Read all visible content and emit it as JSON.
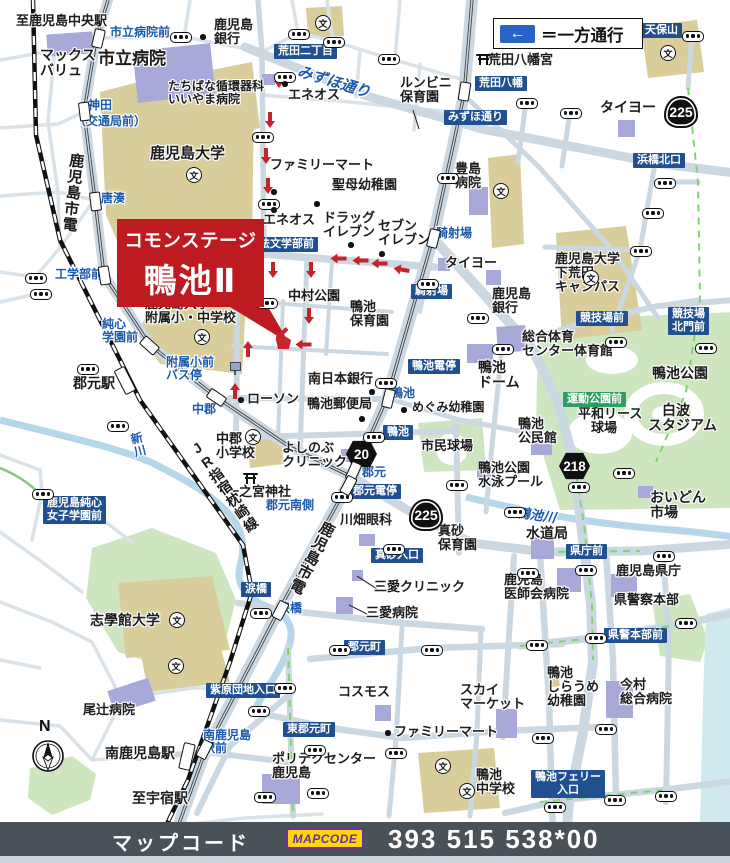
{
  "legend": {
    "arrow": "←",
    "text": "＝一方通行"
  },
  "banner": {
    "line1": "コモンステージ",
    "line2": "鴨池Ⅱ"
  },
  "footer": {
    "label": "マップコード",
    "logo": "MAPCODE",
    "code": "393 515 538*00"
  },
  "compass": {
    "label": "N"
  },
  "colors": {
    "banner_red": "#bd1a21",
    "sign_navy": "#20508f",
    "sign_green": "#2f9e63",
    "blue_text": "#1b59ab",
    "road": "#cbd8e2",
    "campus_tan": "#d8cd9b",
    "park_green": "#cde6c0",
    "building_purple": "#a9a9d9",
    "water": "#b5d7ea",
    "oneway_red": "#c4232a",
    "bar_gray": "#495159",
    "mapcode_yellow": "#ffd60a",
    "mapcode_purple": "#6b2fa0"
  },
  "labels": [
    {
      "t": "至鹿児島中央駅",
      "x": 16,
      "y": 14,
      "n": "dest-kagoshima-chuo-sta"
    },
    {
      "t": "マックス\nバリュ",
      "x": 40,
      "y": 48,
      "s": 14,
      "n": "poi-max-valu"
    },
    {
      "t": "市立病院",
      "x": 98,
      "y": 50,
      "s": 17,
      "n": "poi-city-hospital"
    },
    {
      "t": "鹿児島\n銀行",
      "x": 214,
      "y": 18,
      "n": "poi-kagoshima-bank-1"
    },
    {
      "t": "たちばな循環器科\nいいやま病院",
      "x": 168,
      "y": 80,
      "s": 12,
      "n": "poi-tachibana-iiyama-hospital"
    },
    {
      "t": "エネオス",
      "x": 288,
      "y": 88,
      "n": "poi-eneos-1"
    },
    {
      "t": "ルンビニ\n保育園",
      "x": 400,
      "y": 76,
      "n": "poi-lumbini-nursery"
    },
    {
      "t": "荒田八幡宮",
      "x": 488,
      "y": 53,
      "n": "poi-arata-hachimangu"
    },
    {
      "t": "タイヨー",
      "x": 600,
      "y": 100,
      "s": 14,
      "n": "poi-taiyo-1"
    },
    {
      "t": "鹿児島大学",
      "x": 150,
      "y": 146,
      "s": 15,
      "n": "poi-kagoshima-univ"
    },
    {
      "t": "ファミリーマート",
      "x": 270,
      "y": 158,
      "n": "poi-familymart-1"
    },
    {
      "t": "聖母幼稚園",
      "x": 332,
      "y": 178,
      "n": "poi-seibo-kindergarten"
    },
    {
      "t": "エネオス",
      "x": 263,
      "y": 213,
      "n": "poi-eneos-2"
    },
    {
      "t": "ドラッグ\nイレブン",
      "x": 323,
      "y": 211,
      "n": "poi-drug-eleven"
    },
    {
      "t": "セブン\nイレブン",
      "x": 378,
      "y": 219,
      "n": "poi-seven-eleven"
    },
    {
      "t": "豊島\n病院",
      "x": 455,
      "y": 162,
      "n": "poi-toyoshima-hospital"
    },
    {
      "t": "タイヨー",
      "x": 445,
      "y": 256,
      "n": "poi-taiyo-2"
    },
    {
      "t": "鹿児島\n銀行",
      "x": 492,
      "y": 287,
      "n": "poi-kagoshima-bank-2"
    },
    {
      "t": "鹿児島大学\n下荒田\nキャンパス",
      "x": 555,
      "y": 252,
      "n": "poi-shimoarata-campus"
    },
    {
      "t": "中村公園",
      "x": 288,
      "y": 289,
      "n": "poi-nakamura-park"
    },
    {
      "t": "鴨池\n保育園",
      "x": 350,
      "y": 300,
      "n": "poi-kamoike-nursery"
    },
    {
      "t": "南日本銀行",
      "x": 308,
      "y": 372,
      "n": "poi-minami-nippon-bank"
    },
    {
      "t": "鴨池郵便局",
      "x": 307,
      "y": 397,
      "n": "poi-kamoike-post-office"
    },
    {
      "t": "めぐみ幼稚園",
      "x": 412,
      "y": 401,
      "s": 12,
      "n": "poi-megumi-kindergarten"
    },
    {
      "t": "ローソン",
      "x": 247,
      "y": 392,
      "n": "poi-lawson"
    },
    {
      "t": "市民球場",
      "x": 421,
      "y": 439,
      "n": "poi-shimin-stadium"
    },
    {
      "t": "中郡\n小学校",
      "x": 216,
      "y": 432,
      "n": "poi-nakagori-elementary"
    },
    {
      "t": "よしのぶ\nクリニック",
      "x": 282,
      "y": 441,
      "n": "poi-yoshinobu-clinic"
    },
    {
      "t": "一之宮神社",
      "x": 226,
      "y": 485,
      "n": "poi-ichinomiya-shrine"
    },
    {
      "t": "川畑眼科",
      "x": 340,
      "y": 513,
      "n": "poi-kawabata-eye-clinic"
    },
    {
      "t": "真砂\n保育園",
      "x": 438,
      "y": 524,
      "n": "poi-masago-nursery"
    },
    {
      "t": "三愛クリニック",
      "x": 374,
      "y": 580,
      "n": "poi-sanai-clinic"
    },
    {
      "t": "三愛病院",
      "x": 366,
      "y": 606,
      "n": "poi-sanai-hospital"
    },
    {
      "t": "コスモス",
      "x": 338,
      "y": 685,
      "n": "poi-cosmos"
    },
    {
      "t": "スカイ\nマーケット",
      "x": 460,
      "y": 683,
      "n": "poi-sky-market"
    },
    {
      "t": "ファミリーマート",
      "x": 394,
      "y": 725,
      "n": "poi-familymart-2"
    },
    {
      "t": "ポリテクセンター\n鹿児島",
      "x": 272,
      "y": 752,
      "n": "poi-polytech-center"
    },
    {
      "t": "鴨池\n中学校",
      "x": 476,
      "y": 768,
      "n": "poi-kamoike-junior-high"
    },
    {
      "t": "鴨池\nしらうめ\n幼稚園",
      "x": 547,
      "y": 666,
      "n": "poi-shiraume-kindergarten"
    },
    {
      "t": "今村\n総合病院",
      "x": 620,
      "y": 678,
      "n": "poi-imamura-hospital"
    },
    {
      "t": "鹿児島\n医師会病院",
      "x": 504,
      "y": 573,
      "n": "poi-ishikai-hospital"
    },
    {
      "t": "鹿児島県庁",
      "x": 616,
      "y": 564,
      "n": "poi-pref-office"
    },
    {
      "t": "県警察本部",
      "x": 614,
      "y": 593,
      "n": "poi-pref-police-hq"
    },
    {
      "t": "水道局",
      "x": 526,
      "y": 526,
      "s": 14,
      "n": "poi-waterworks"
    },
    {
      "t": "おいどん\n市場",
      "x": 650,
      "y": 490,
      "s": 14,
      "n": "poi-oidon-market"
    },
    {
      "t": "総合体育\nセンター体育館",
      "x": 522,
      "y": 330,
      "n": "poi-sogo-gym"
    },
    {
      "t": "鴨池\nドーム",
      "x": 478,
      "y": 360,
      "s": 14,
      "n": "poi-kamoike-dome"
    },
    {
      "t": "鴨池公園",
      "x": 652,
      "y": 366,
      "s": 14,
      "n": "poi-kamoike-park"
    },
    {
      "t": "　白波\nスタジアム",
      "x": 648,
      "y": 403,
      "s": 14,
      "n": "poi-shiranami-stadium"
    },
    {
      "t": "平和リース\n　球場",
      "x": 578,
      "y": 407,
      "n": "poi-heiwa-lease-stadium"
    },
    {
      "t": "鴨池\n公民館",
      "x": 518,
      "y": 417,
      "n": "poi-kamoike-kominkan"
    },
    {
      "t": "鴨池公園\n水泳プール",
      "x": 478,
      "y": 461,
      "n": "poi-kamoike-pool"
    },
    {
      "t": "志學館大学",
      "x": 90,
      "y": 613,
      "s": 14,
      "n": "poi-shigakukan-univ"
    },
    {
      "t": "尾辻病院",
      "x": 83,
      "y": 703,
      "n": "poi-otsuji-hospital"
    },
    {
      "t": "南鹿児島駅",
      "x": 105,
      "y": 746,
      "s": 14,
      "n": "poi-minami-kagoshima-sta"
    },
    {
      "t": "至宇宿駅",
      "x": 132,
      "y": 791,
      "s": 14,
      "n": "dest-usuki-sta"
    },
    {
      "t": "郡元駅",
      "x": 73,
      "y": 376,
      "s": 14,
      "n": "poi-korimoto-sta"
    },
    {
      "t": "鹿児島大学\n附属小・中学校",
      "x": 145,
      "y": 297,
      "n": "poi-fuzoku-school"
    },
    {
      "t": "鹿児島市電",
      "x": 68,
      "y": 152,
      "s": 15,
      "c": "v",
      "r": 6,
      "n": "line-shiden-upper"
    },
    {
      "t": "鹿児島市電",
      "x": 322,
      "y": 518,
      "s": 15,
      "c": "v",
      "r": 27,
      "n": "line-shiden-lower"
    },
    {
      "t": "JR指宿枕崎線",
      "x": 186,
      "y": 446,
      "s": 14,
      "c": "v",
      "r": -35,
      "n": "line-jr-ibusuki-makurazaki"
    },
    {
      "t": "市立病院前",
      "x": 110,
      "y": 26,
      "s": 12,
      "c": "b",
      "n": "stop-shiritsu-byoin-mae"
    },
    {
      "t": "神田",
      "x": 88,
      "y": 99,
      "s": 12,
      "c": "b",
      "n": "stop-kanda"
    },
    {
      "t": "（交通局前）",
      "x": 74,
      "y": 115,
      "s": 12,
      "c": "b",
      "n": "stop-kotsukyoku-mae"
    },
    {
      "t": "唐湊",
      "x": 101,
      "y": 192,
      "s": 12,
      "c": "b",
      "n": "stop-toso"
    },
    {
      "t": "工学部前",
      "x": 55,
      "y": 268,
      "s": 12,
      "c": "b",
      "n": "stop-kogakubu-mae"
    },
    {
      "t": "純心\n学園前",
      "x": 102,
      "y": 318,
      "s": 12,
      "c": "b",
      "n": "stop-junshin-gakuen-mae"
    },
    {
      "t": "附属小前\nバス停",
      "x": 166,
      "y": 356,
      "s": 12,
      "c": "b",
      "n": "stop-fuzokusho-mae-bus"
    },
    {
      "t": "中郡",
      "x": 192,
      "y": 403,
      "s": 12,
      "c": "b",
      "n": "stop-nakagori"
    },
    {
      "t": "郡元",
      "x": 362,
      "y": 466,
      "s": 12,
      "c": "b",
      "n": "stop-korimoto"
    },
    {
      "t": "郡元南側",
      "x": 266,
      "y": 499,
      "s": 12,
      "c": "b",
      "n": "stop-korimoto-minamigawa"
    },
    {
      "t": "涙橋",
      "x": 278,
      "y": 602,
      "s": 12,
      "c": "b",
      "n": "stop-namidabashi"
    },
    {
      "t": "南鹿児島\n駅前",
      "x": 203,
      "y": 729,
      "s": 12,
      "c": "b",
      "n": "stop-minami-kagoshima-ekimae"
    },
    {
      "t": "騎射場",
      "x": 436,
      "y": 227,
      "s": 12,
      "c": "b",
      "n": "stop-kishaba"
    },
    {
      "t": "鴨池",
      "x": 391,
      "y": 387,
      "s": 12,
      "c": "b",
      "n": "stop-kamoike"
    },
    {
      "t": "みずほ通り",
      "x": 300,
      "y": 64,
      "s": 15,
      "c": "bi",
      "r": 17,
      "n": "road-mizuho-dori"
    },
    {
      "t": "新川",
      "x": 128,
      "y": 434,
      "s": 12,
      "c": "bv",
      "r": -14,
      "n": "river-shinkawa"
    },
    {
      "t": "鴨池川",
      "x": 518,
      "y": 506,
      "s": 13,
      "c": "bi",
      "r": 8,
      "n": "river-kamoike-gawa"
    }
  ],
  "signs": [
    {
      "t": "荒田二丁目",
      "x": 274,
      "y": 44,
      "n": "sign-arata-2chome"
    },
    {
      "t": "天保山",
      "x": 641,
      "y": 23,
      "n": "sign-tempozan"
    },
    {
      "t": "荒田八幡",
      "x": 475,
      "y": 76,
      "n": "sign-arata-hachiman"
    },
    {
      "t": "みずほ通り",
      "x": 444,
      "y": 110,
      "n": "sign-mizuho-dori"
    },
    {
      "t": "浜橋北口",
      "x": 633,
      "y": 153,
      "n": "sign-hamabashi-kitaguchi"
    },
    {
      "t": "法文学部前",
      "x": 255,
      "y": 237,
      "n": "sign-hobungakubu-mae"
    },
    {
      "t": "騎射場",
      "x": 411,
      "y": 284,
      "n": "sign-kishaba"
    },
    {
      "t": "鴨池電停",
      "x": 408,
      "y": 359,
      "n": "sign-kamoike-densha"
    },
    {
      "t": "鴨池",
      "x": 383,
      "y": 425,
      "n": "sign-kamoike"
    },
    {
      "t": "郡元電停",
      "x": 349,
      "y": 484,
      "n": "sign-korimoto-densha"
    },
    {
      "t": "競技場前",
      "x": 576,
      "y": 311,
      "n": "sign-kyogijo-mae"
    },
    {
      "t": "競技場\n北門前",
      "x": 668,
      "y": 307,
      "n": "sign-kyogijo-kitamon-mae"
    },
    {
      "t": "真砂入口",
      "x": 371,
      "y": 548,
      "n": "sign-masago-iriguchi"
    },
    {
      "t": "県庁前",
      "x": 566,
      "y": 544,
      "n": "sign-kencho-mae"
    },
    {
      "t": "県警本部前",
      "x": 604,
      "y": 628,
      "n": "sign-keikei-honbu-mae"
    },
    {
      "t": "涙橋",
      "x": 241,
      "y": 582,
      "n": "sign-namidabashi"
    },
    {
      "t": "郡元町",
      "x": 344,
      "y": 640,
      "n": "sign-korimoto-cho"
    },
    {
      "t": "東郡元町",
      "x": 283,
      "y": 722,
      "n": "sign-higashi-korimoto-cho"
    },
    {
      "t": "紫原団地入口",
      "x": 206,
      "y": 683,
      "n": "sign-murasakibaru-danchi"
    },
    {
      "t": "鴨池フェリー\n入口",
      "x": 531,
      "y": 770,
      "n": "sign-kamoike-ferry"
    },
    {
      "t": "鹿児島純心\n女子学園前",
      "x": 43,
      "y": 496,
      "n": "sign-junshin-joshi-gakuen"
    },
    {
      "t": "運動公園前",
      "x": 563,
      "y": 392,
      "g": true,
      "n": "sign-undo-koen-mae"
    }
  ],
  "badges": [
    {
      "n": "225",
      "x": 664,
      "y": 96,
      "k": "r"
    },
    {
      "n": "225",
      "x": 409,
      "y": 499,
      "k": "r"
    },
    {
      "n": "20",
      "x": 346,
      "y": 440,
      "k": "h"
    },
    {
      "n": "218",
      "x": 559,
      "y": 452,
      "k": "h"
    }
  ],
  "arrows": [
    [
      274,
      72,
      0
    ],
    [
      265,
      112,
      0
    ],
    [
      261,
      148,
      0
    ],
    [
      263,
      178,
      0
    ],
    [
      268,
      262,
      0
    ],
    [
      306,
      262,
      0
    ],
    [
      304,
      308,
      0
    ],
    [
      333,
      250,
      90
    ],
    [
      355,
      252,
      90
    ],
    [
      374,
      255,
      90
    ],
    [
      396,
      261,
      100
    ],
    [
      298,
      336,
      90
    ],
    [
      276,
      326,
      45
    ],
    [
      243,
      340,
      180
    ],
    [
      230,
      382,
      180
    ]
  ],
  "lights": [
    [
      180,
      36
    ],
    [
      298,
      33
    ],
    [
      333,
      41
    ],
    [
      388,
      58
    ],
    [
      692,
      35
    ],
    [
      526,
      102
    ],
    [
      570,
      112
    ],
    [
      664,
      182
    ],
    [
      652,
      212
    ],
    [
      447,
      177
    ],
    [
      262,
      136
    ],
    [
      284,
      76
    ],
    [
      35,
      277
    ],
    [
      40,
      293
    ],
    [
      268,
      203
    ],
    [
      143,
      257
    ],
    [
      266,
      302
    ],
    [
      87,
      368
    ],
    [
      117,
      425
    ],
    [
      42,
      493
    ],
    [
      260,
      612
    ],
    [
      341,
      496
    ],
    [
      393,
      548
    ],
    [
      456,
      484
    ],
    [
      502,
      348
    ],
    [
      615,
      341
    ],
    [
      640,
      250
    ],
    [
      477,
      317
    ],
    [
      705,
      347
    ],
    [
      427,
      283
    ],
    [
      385,
      382
    ],
    [
      373,
      436
    ],
    [
      623,
      472
    ],
    [
      578,
      486
    ],
    [
      514,
      511
    ],
    [
      527,
      572
    ],
    [
      585,
      569
    ],
    [
      663,
      555
    ],
    [
      685,
      622
    ],
    [
      595,
      637
    ],
    [
      536,
      644
    ],
    [
      339,
      649
    ],
    [
      431,
      649
    ],
    [
      284,
      687
    ],
    [
      258,
      710
    ],
    [
      314,
      749
    ],
    [
      395,
      752
    ],
    [
      264,
      796
    ],
    [
      317,
      792
    ],
    [
      605,
      728
    ],
    [
      542,
      737
    ],
    [
      614,
      799
    ],
    [
      665,
      795
    ],
    [
      554,
      806
    ]
  ],
  "dots": [
    [
      203,
      37
    ],
    [
      285,
      84
    ],
    [
      274,
      192
    ],
    [
      274,
      210
    ],
    [
      317,
      204
    ],
    [
      351,
      245
    ],
    [
      382,
      254
    ],
    [
      372,
      392
    ],
    [
      362,
      419
    ],
    [
      404,
      410
    ],
    [
      241,
      400
    ],
    [
      388,
      733
    ]
  ],
  "schools": [
    [
      322,
      22
    ],
    [
      667,
      52
    ],
    [
      193,
      174
    ],
    [
      201,
      336
    ],
    [
      252,
      436
    ],
    [
      590,
      277
    ],
    [
      176,
      619
    ],
    [
      175,
      665
    ],
    [
      442,
      765
    ],
    [
      466,
      790
    ],
    [
      500,
      190
    ]
  ],
  "toriis": [
    [
      477,
      54
    ],
    [
      244,
      473
    ]
  ],
  "stations": [
    {
      "x": 97,
      "y": 37,
      "r": 13
    },
    {
      "x": 83,
      "y": 110,
      "r": -7
    },
    {
      "x": 94,
      "y": 200,
      "r": -7
    },
    {
      "x": 103,
      "y": 274,
      "r": -9
    },
    {
      "x": 148,
      "y": 344,
      "r": -48
    },
    {
      "x": 215,
      "y": 396,
      "r": -56
    },
    {
      "x": 352,
      "y": 470,
      "r": 24
    },
    {
      "x": 347,
      "y": 484,
      "r": 28
    },
    {
      "x": 279,
      "y": 609,
      "r": 27
    },
    {
      "x": 203,
      "y": 748,
      "r": 27
    },
    {
      "x": 463,
      "y": 90,
      "r": 9
    },
    {
      "x": 432,
      "y": 237,
      "r": 14
    },
    {
      "x": 387,
      "y": 397,
      "r": 14
    },
    {
      "x": 124,
      "y": 379,
      "r": -27,
      "jr": true
    },
    {
      "x": 186,
      "y": 755,
      "r": 13,
      "jr": true
    }
  ],
  "bus_stops": [
    [
      230,
      362
    ]
  ]
}
